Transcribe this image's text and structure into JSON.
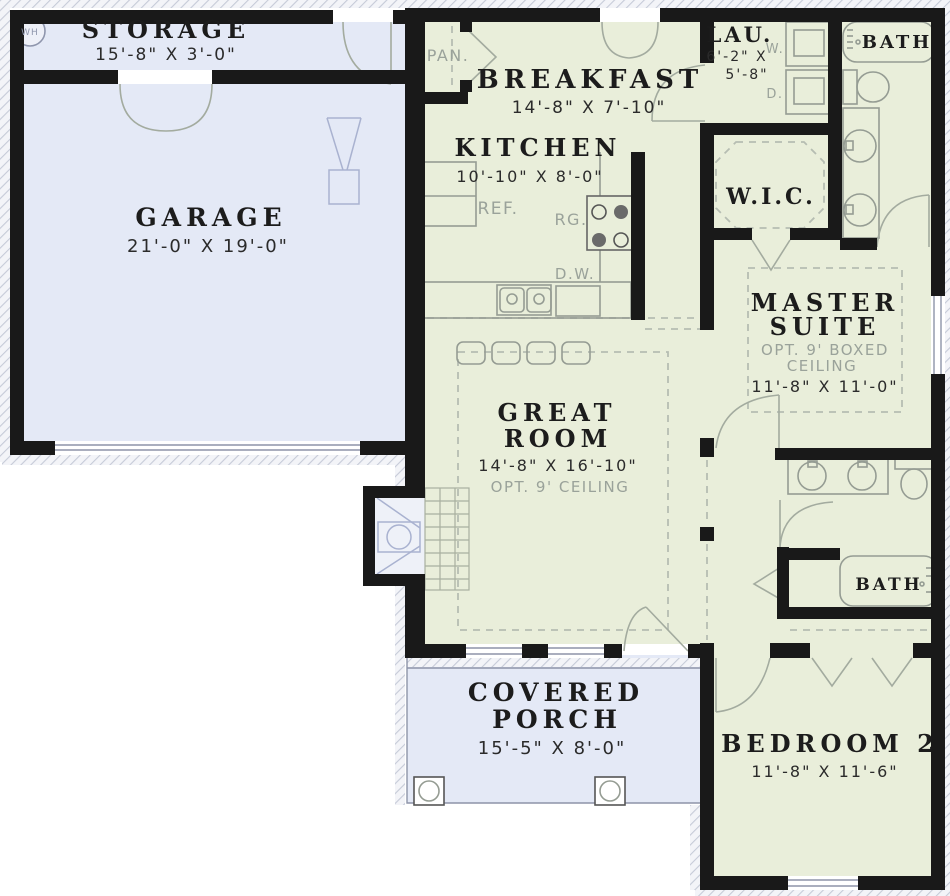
{
  "plan": {
    "rooms": {
      "storage": {
        "name": "STORAGE",
        "dims": "15'-8\" X 3'-0\""
      },
      "garage": {
        "name": "GARAGE",
        "dims": "21'-0\" X 19'-0\""
      },
      "breakfast": {
        "name": "BREAKFAST",
        "dims": "14'-8\" X 7'-10\""
      },
      "kitchen": {
        "name": "KITCHEN",
        "dims": "10'-10\" X 8'-0\""
      },
      "laundry": {
        "name": "LAU.",
        "dims_line1": "6'-2\" X",
        "dims_line2": "5'-8\""
      },
      "master_bath": {
        "name": "BATH"
      },
      "wic": {
        "name": "W.I.C."
      },
      "master_suite": {
        "name_line1": "MASTER",
        "name_line2": "SUITE",
        "note_line1": "OPT. 9' BOXED",
        "note_line2": "CEILING",
        "dims": "11'-8\" X 11'-0\""
      },
      "great_room": {
        "name_line1": "GREAT",
        "name_line2": "ROOM",
        "dims": "14'-8\" X 16'-10\"",
        "note": "OPT. 9' CEILING"
      },
      "bath2": {
        "name": "BATH"
      },
      "porch": {
        "name_line1": "COVERED",
        "name_line2": "PORCH",
        "dims": "15'-5\" X 8'-0\""
      },
      "bedroom2": {
        "name": "BEDROOM 2",
        "dims": "11'-8\" X 11'-6\""
      }
    },
    "annotations": {
      "pantry": "PAN.",
      "fridge": "REF.",
      "range": "RG.",
      "dishwasher": "D.W.",
      "washer": "W.",
      "dryer": "D.",
      "water_heater": "WH"
    },
    "colors": {
      "wall": "#191919",
      "interior_fill": "#e9eeda",
      "garage_fill": "#e4e9f6",
      "annotation_text": "#9aa29a",
      "label_text": "#1c1c1c"
    }
  }
}
